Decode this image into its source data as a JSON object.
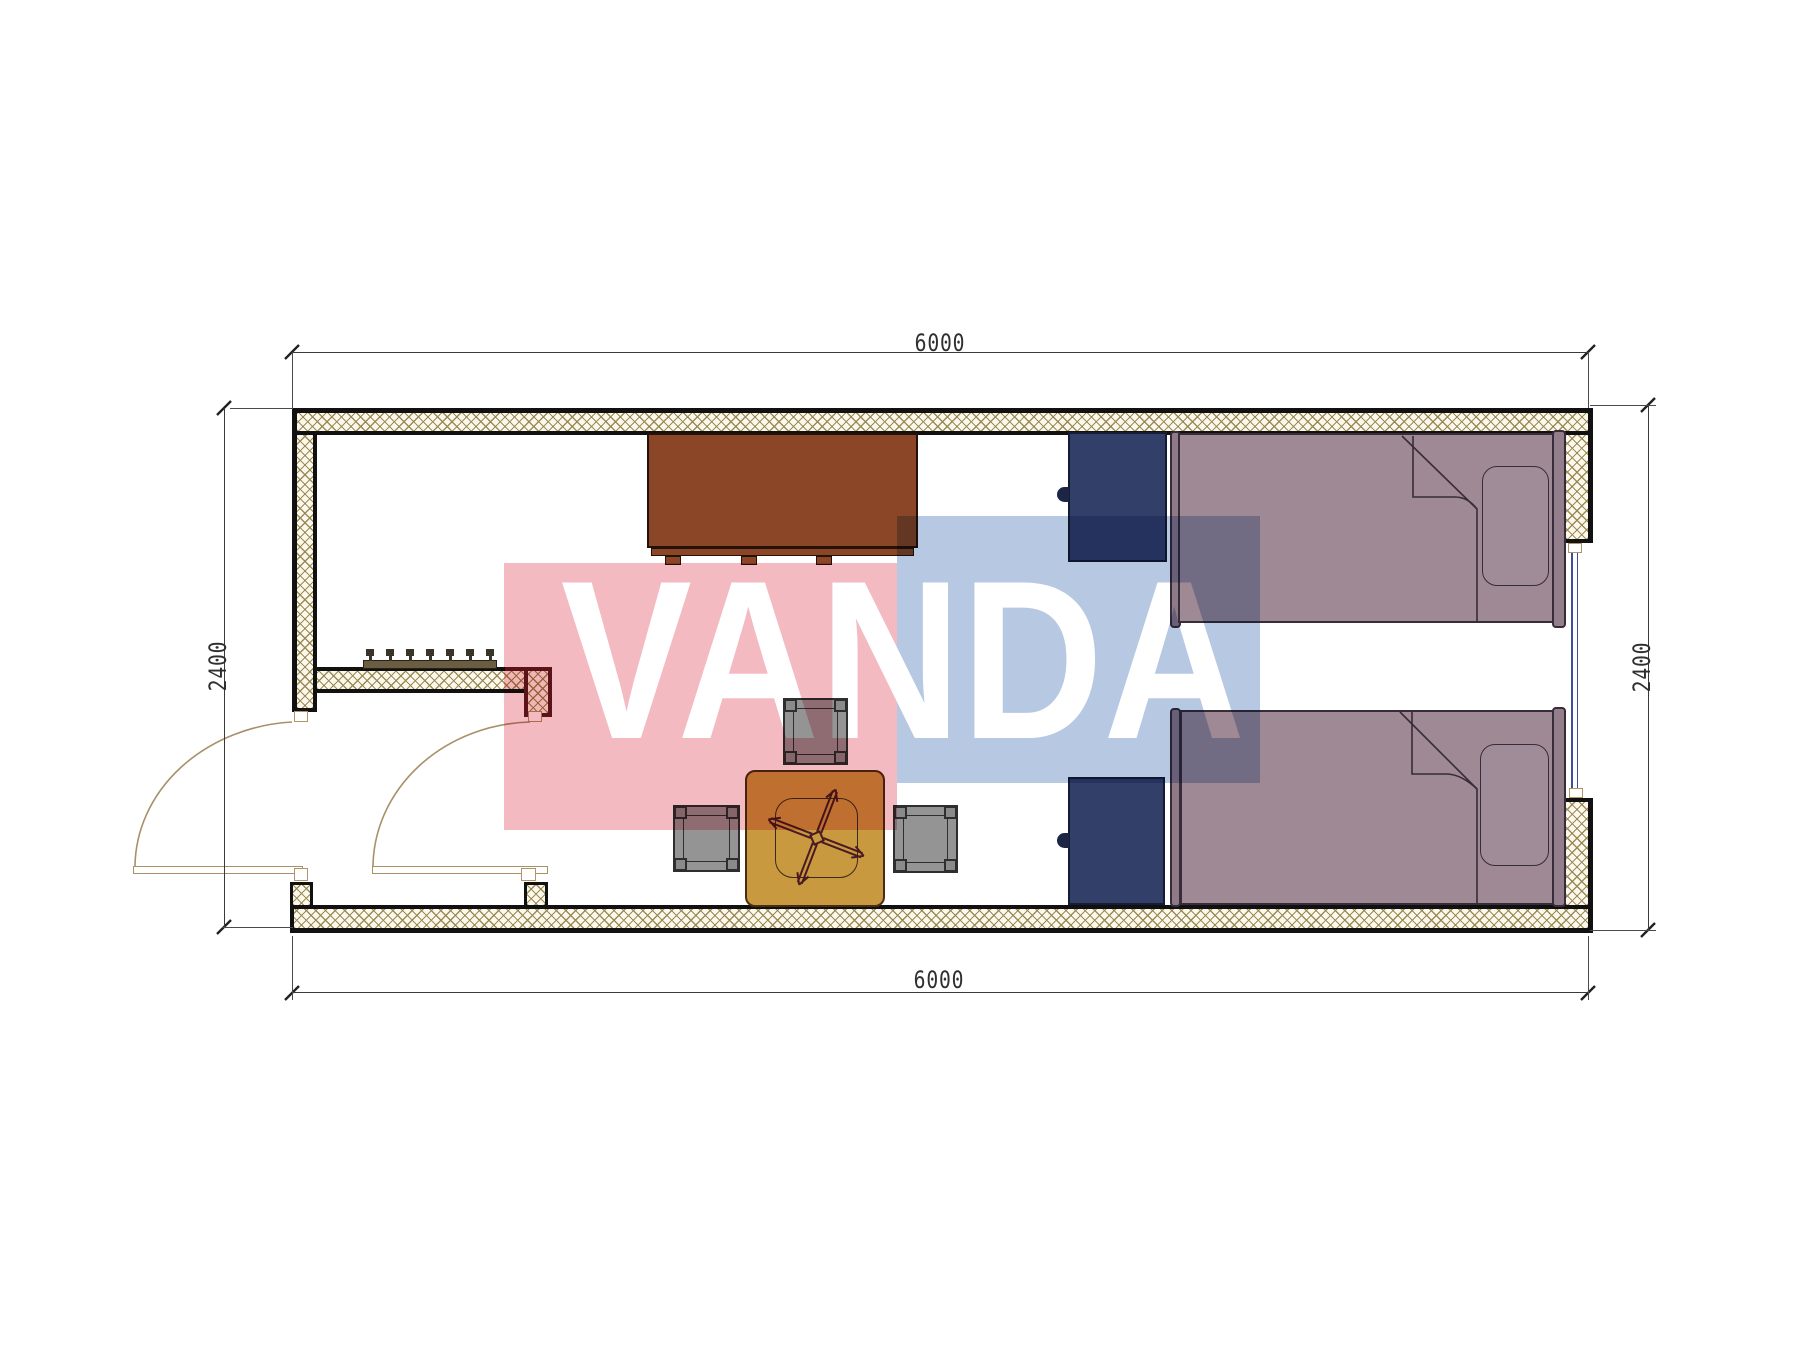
{
  "drawing": {
    "type": "floor-plan",
    "room_count": 2,
    "units": "mm"
  },
  "dimensions": {
    "top": {
      "label": "6000"
    },
    "bottom": {
      "label": "6000"
    },
    "left": {
      "label": "2400"
    },
    "right": {
      "label": "2400"
    }
  },
  "watermark": {
    "text": "VANDA",
    "pink_color": "#f4bac2",
    "blue_color": "#b7c9e2",
    "letter_color": "#ffffff"
  },
  "colors": {
    "wall_outline": "#111111",
    "wall_hatch_line": "#96854f",
    "wall_hatch_bg": "#fdf8ec",
    "partition_accent": "#5e1a20",
    "bed_fill": "#9e8994",
    "bed_frame": "#8f7a87",
    "bed_outline": "#372c3a",
    "nightstand_fill": "#323f69",
    "desk_fill": "#8a4627",
    "table_fill": "#c8993f",
    "chair_symbol": "#4a1a22",
    "stool_fill": "#949494",
    "door_arc": "#a8906a",
    "window_glazing": "#3b4f9b",
    "dimension_text": "#2f2f2f"
  },
  "furniture": {
    "beds": 2,
    "pillows": 2,
    "nightstands": 2,
    "desk": 1,
    "tea_table": 1,
    "stools": 3,
    "office_chair_symbol": 1,
    "coat_rack_pegs": 7,
    "entry_doors": 2,
    "windows": 1
  }
}
